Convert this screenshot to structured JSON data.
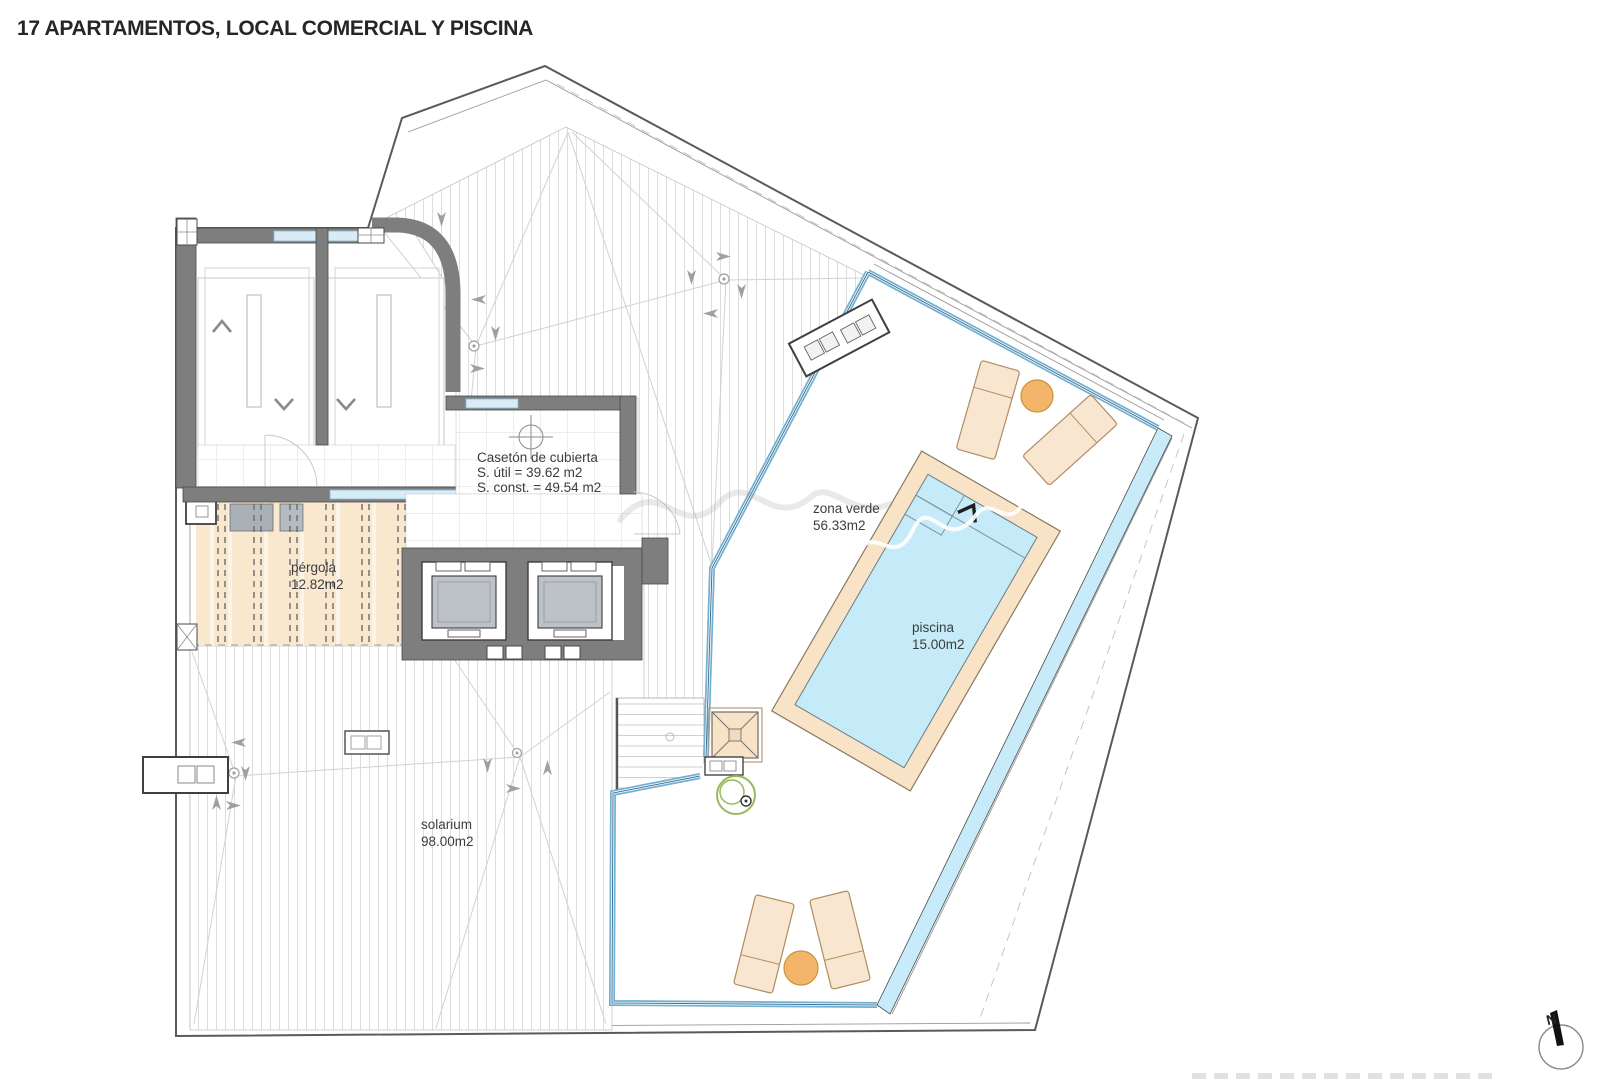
{
  "title": "17 APARTAMENTOS, LOCAL COMERCIAL Y PISCINA",
  "plan": {
    "rooms": {
      "caseton": {
        "name": "Casetón de cubierta",
        "util": "S. útil = 39.62 m2",
        "const": "S. const. = 49.54 m2"
      },
      "zona_verde": {
        "name": "zona verde",
        "area": "56.33m2"
      },
      "piscina": {
        "name": "piscina",
        "area": "15.00m2"
      },
      "pergola": {
        "name": "pérgola",
        "area": "12.82m2"
      },
      "solarium": {
        "name": "solarium",
        "area": "98.00m2"
      }
    },
    "compass": {
      "label": "N"
    }
  },
  "colors": {
    "ink": "#262626",
    "labelink": "#3d3d3d",
    "wall": "#7e7e7e",
    "glass": "#6fb0d4",
    "pool": "#c5eaf8",
    "deck": "#f8e3c6",
    "lounger": "#f9e6d0",
    "table": "#f2b569",
    "plant": "#9ab85c"
  }
}
